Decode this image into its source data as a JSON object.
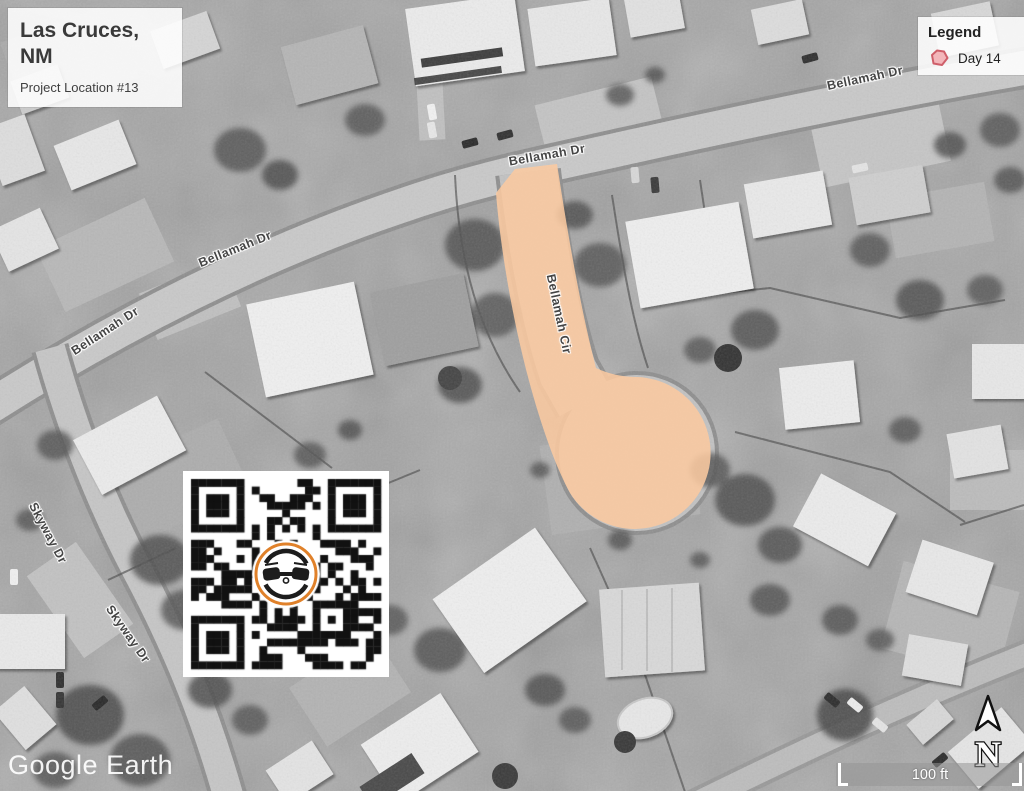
{
  "title_card": {
    "line1": "Las Cruces,",
    "line2": "NM",
    "subtitle": "Project Location #13"
  },
  "legend": {
    "title": "Legend",
    "items": [
      {
        "label": "Day 14",
        "fill": "#f3b6ba",
        "stroke": "#cf5f6a"
      }
    ]
  },
  "road_labels": [
    {
      "text": "Bellamah Dr",
      "x": 547,
      "y": 155,
      "rot": -10
    },
    {
      "text": "Bellamah Dr",
      "x": 865,
      "y": 78,
      "rot": -12
    },
    {
      "text": "Bellamah Dr",
      "x": 235,
      "y": 249,
      "rot": -22
    },
    {
      "text": "Bellamah Dr",
      "x": 105,
      "y": 331,
      "rot": -33
    },
    {
      "text": "Bellamah Cir",
      "x": 559,
      "y": 314,
      "rot": 78
    },
    {
      "text": "Skyway Dr",
      "x": 48,
      "y": 533,
      "rot": 62
    },
    {
      "text": "Skyway Dr",
      "x": 128,
      "y": 634,
      "rot": 55
    }
  ],
  "highlight": {
    "color": "#fbc9a0"
  },
  "watermark": {
    "text": "Google Earth"
  },
  "scale_bar": {
    "label": "100 ft"
  },
  "north_arrow": {
    "label": "N"
  },
  "qr": {
    "icon": "drone-icon",
    "accent": "#e0812a"
  }
}
